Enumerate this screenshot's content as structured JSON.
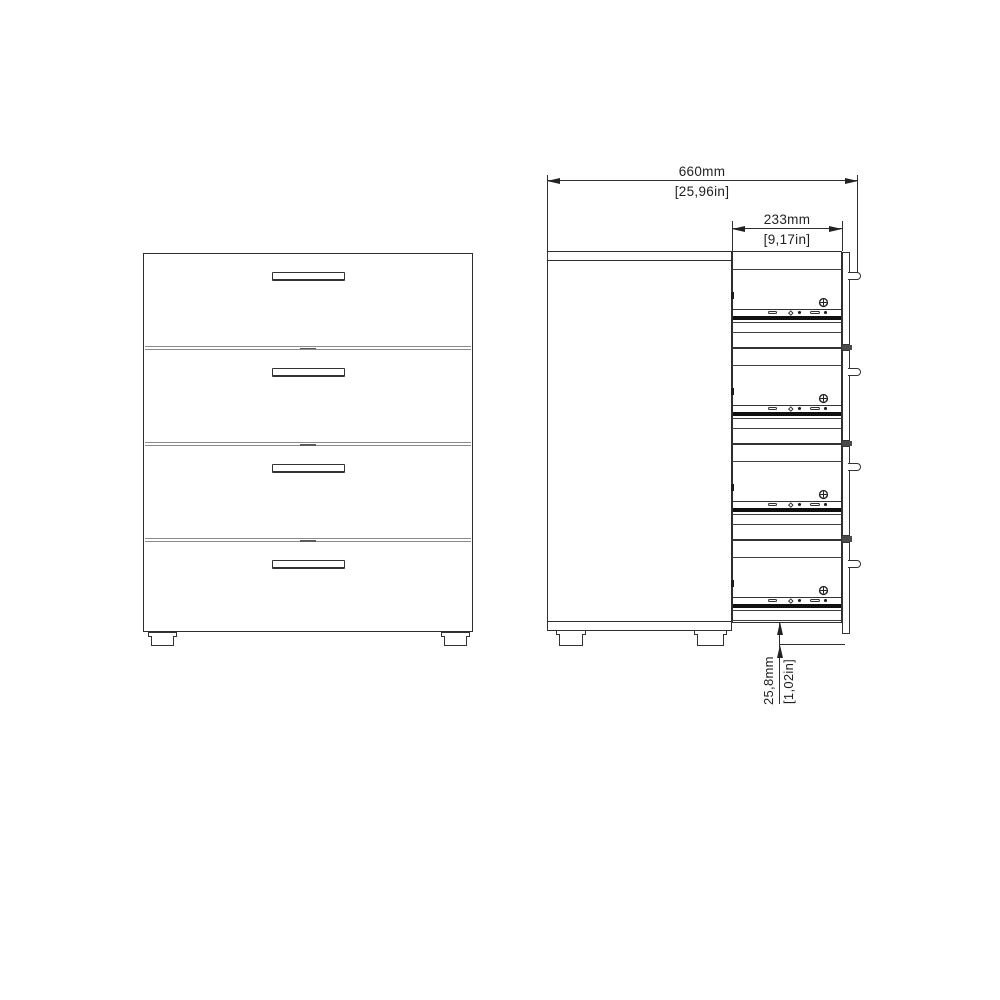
{
  "dimensions": {
    "width": {
      "mm": "660mm",
      "in": "[25,96in]"
    },
    "drawer_depth": {
      "mm": "233mm",
      "in": "[9,17in]"
    },
    "foot_height": {
      "mm": "25,8mm",
      "in": "[1,02in]"
    }
  },
  "front_view": {
    "drawers": 4,
    "handles": 4,
    "feet": 2
  },
  "side_view": {
    "drawers": 4,
    "drawer_slides": 4,
    "screws": 4,
    "handle_stubs": 4,
    "feet": 2
  },
  "colors": {
    "line": "#2e2e2e",
    "slide_rail": "#101010",
    "drawer_divider": "#8c8c8c",
    "background": "#ffffff"
  }
}
